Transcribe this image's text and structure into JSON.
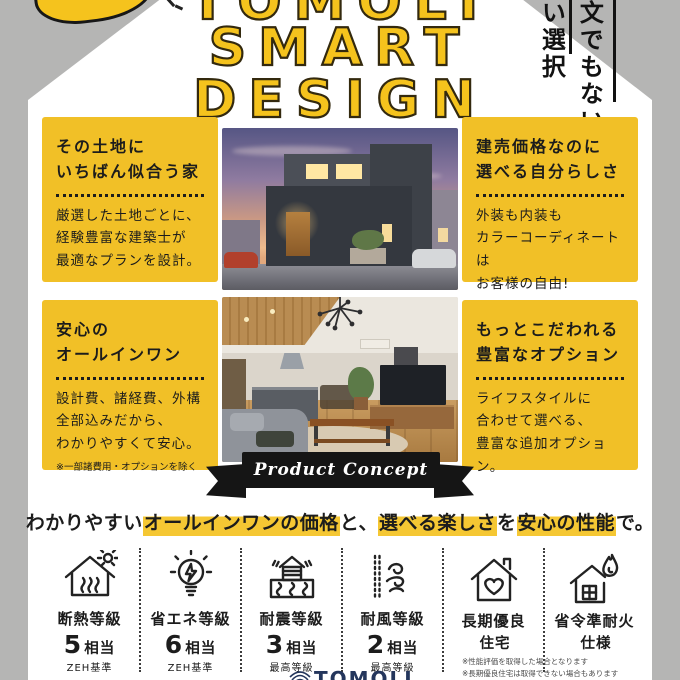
{
  "colors": {
    "accent_yellow": "#F1C027",
    "background_gray": "#B5B5B4",
    "ink": "#1C1C1C",
    "ribbon_black": "#151515",
    "highlight_yellow": "#F5C733",
    "logo_navy": "#24365C"
  },
  "header": {
    "brand_word_cropped": "TOMOLI",
    "title_word2": "SMART",
    "title_word3": "DESIGN",
    "vertical_phrase_right": "文でもない",
    "vertical_phrase_left": "い選択"
  },
  "features": [
    {
      "title_lines": [
        "その土地に",
        "いちばん似合う家"
      ],
      "body_lines": [
        "厳選した土地ごとに、",
        "経験豊富な建築士が",
        "最適なプランを設計。"
      ],
      "note": ""
    },
    {
      "title_lines": [
        "建売価格なのに",
        "選べる自分らしさ"
      ],
      "body_lines": [
        "外装も内装も",
        "カラーコーディネートは",
        "お客様の自由!"
      ],
      "note": ""
    },
    {
      "title_lines": [
        "安心の",
        "オールインワン"
      ],
      "body_lines": [
        "設計費、諸経費、外構",
        "全部込みだから、",
        "わかりやすくて安心。"
      ],
      "note": "※一部諸費用・オプションを除く"
    },
    {
      "title_lines": [
        "もっとこだわれる",
        "豊富なオプション"
      ],
      "body_lines": [
        "ライフスタイルに",
        "合わせて選べる、",
        "豊富な追加オプション。"
      ],
      "note": ""
    }
  ],
  "ribbon": {
    "label": "Product Concept"
  },
  "tagline": {
    "segments": [
      {
        "text": "わかりやすい",
        "highlight": false
      },
      {
        "text": "オールインワンの価格",
        "highlight": true
      },
      {
        "text": "と、",
        "highlight": false
      },
      {
        "text": "選べる楽しさ",
        "highlight": true
      },
      {
        "text": "を",
        "highlight": false
      },
      {
        "text": "安心の性能",
        "highlight": true
      },
      {
        "text": "で。",
        "highlight": false
      }
    ]
  },
  "specs": [
    {
      "label": "断熱等級",
      "num": "5",
      "unit": "相当",
      "note": "ZEH基準",
      "icon": "insulation-house-icon"
    },
    {
      "label": "省エネ等級",
      "num": "6",
      "unit": "相当",
      "note": "ZEH基準",
      "icon": "energy-saving-bulb-icon"
    },
    {
      "label": "耐震等級",
      "num": "3",
      "unit": "相当",
      "note": "最高等級",
      "icon": "earthquake-resistance-icon"
    },
    {
      "label": "耐風等級",
      "num": "2",
      "unit": "相当",
      "note": "最高等級",
      "icon": "wind-resistance-icon"
    },
    {
      "label": "長期優良",
      "num": "",
      "unit": "住宅",
      "note": "",
      "icon": "heart-house-icon"
    },
    {
      "label": "省令準耐火",
      "num": "",
      "unit": "仕様",
      "note": "",
      "icon": "fireproof-house-icon"
    }
  ],
  "footer": {
    "logo_text": "TOMOLI",
    "notes": [
      "※性能評価を取得した場合となります",
      "※長期優良住宅は取得できない場合もあります"
    ]
  }
}
